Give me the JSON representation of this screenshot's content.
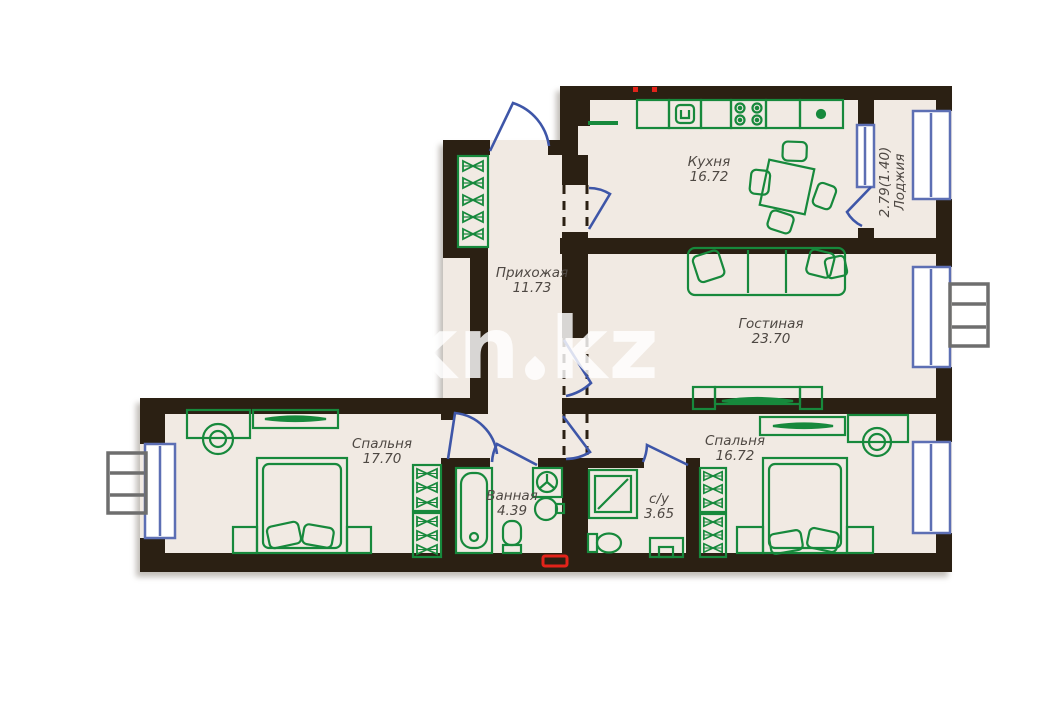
{
  "watermark": {
    "left": "kn",
    "right": "kz"
  },
  "rooms": [
    {
      "id": "kitchen",
      "name": "Кухня",
      "area": "16.72"
    },
    {
      "id": "loggia",
      "name": "Лоджия",
      "area": "2.79(1.40)"
    },
    {
      "id": "hallway",
      "name": "Прихожая",
      "area": "11.73"
    },
    {
      "id": "living-room",
      "name": "Гостиная",
      "area": "23.70"
    },
    {
      "id": "bedroom-left",
      "name": "Спальня",
      "area": "17.70"
    },
    {
      "id": "bedroom-right",
      "name": "Спальня",
      "area": "16.72"
    },
    {
      "id": "bathroom",
      "name": "Ванная",
      "area": "4.39"
    },
    {
      "id": "wc",
      "name": "с/у",
      "area": "3.65"
    }
  ],
  "colors": {
    "wall": "#2b2013",
    "floor": "#f1eae3",
    "furniture": "#17893c",
    "door": "#3e56a8",
    "window": "#5d6fb4",
    "accent_red": "#e2231a"
  }
}
